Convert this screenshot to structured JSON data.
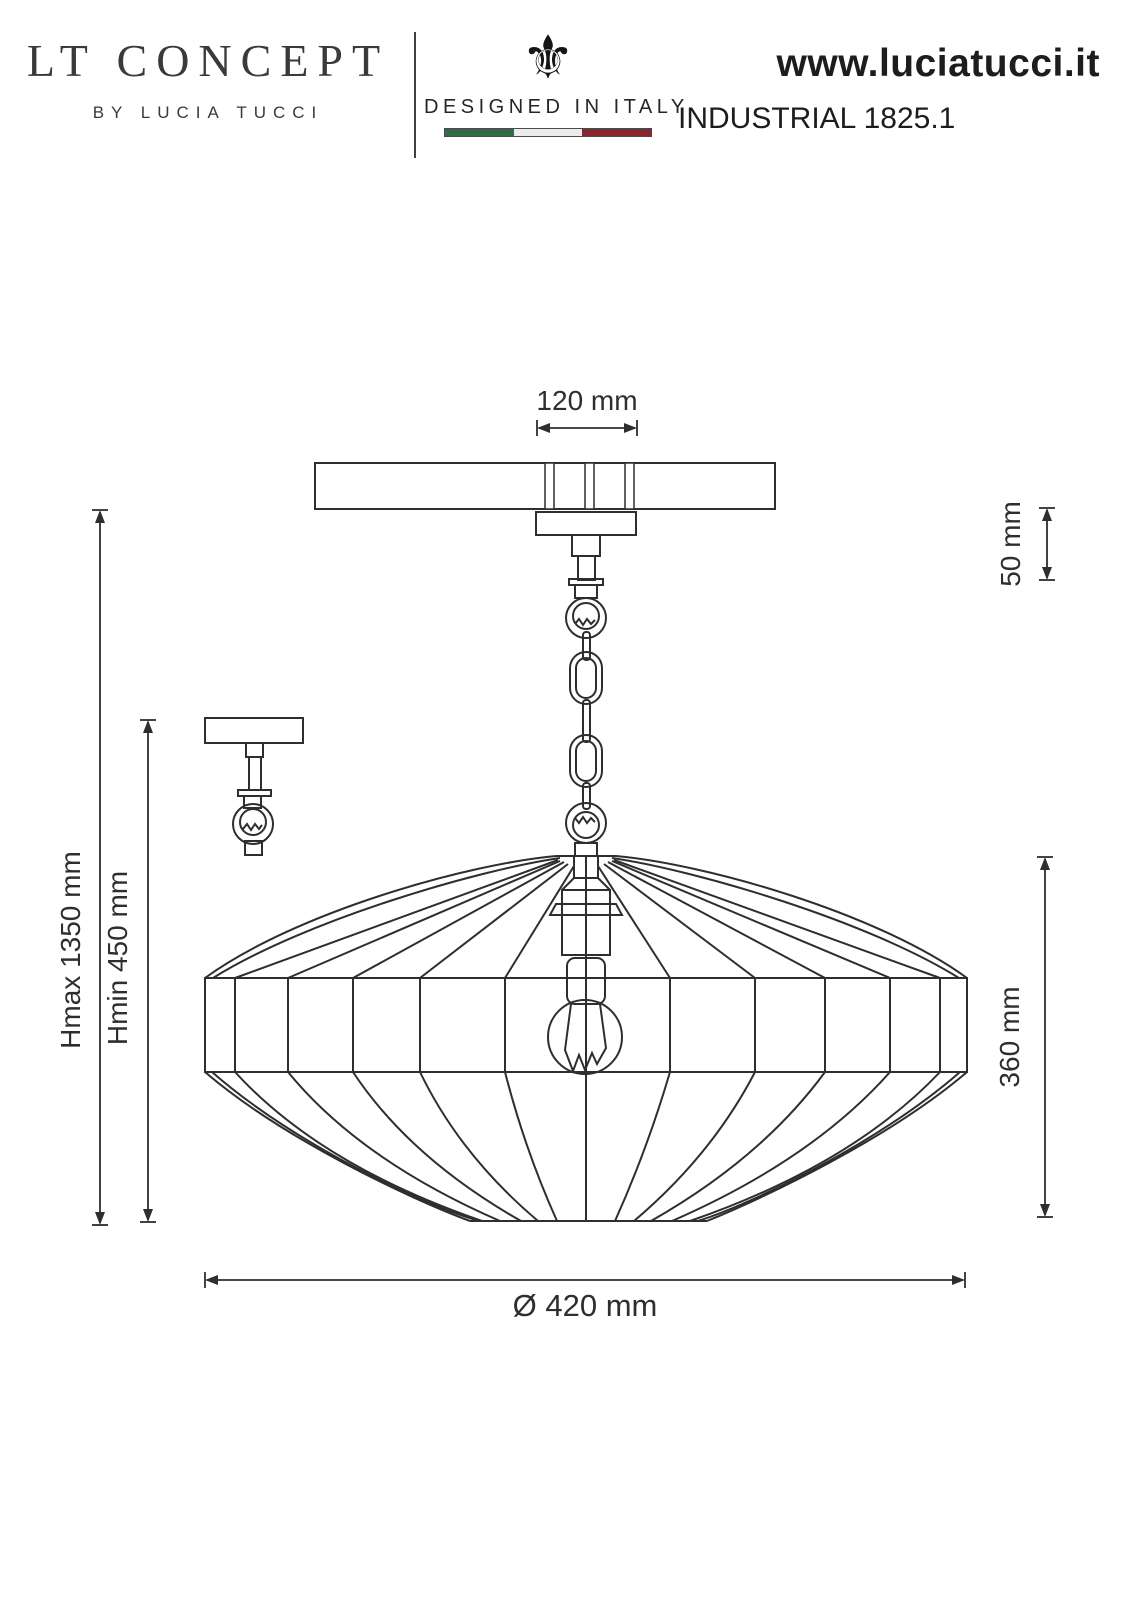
{
  "header": {
    "brand": {
      "title": "LT CONCEPT",
      "subtitle": "BY LUCIA TUCCI"
    },
    "designed_in_italy": {
      "icon": "⚜",
      "label": "DESIGNED IN ITALY",
      "flag_colors": {
        "green": "#2d6e48",
        "white": "#ececec",
        "red": "#8e2330"
      }
    },
    "website": "www.luciatucci.it",
    "model": "INDUSTRIAL 1825.1"
  },
  "drawing": {
    "ink_color": "#2e2e2e",
    "dimensions": {
      "canopy_width": "120 mm",
      "canopy_drop": "50 mm",
      "max_height": "Hmax 1350 mm",
      "min_height": "Hmin 450 mm",
      "shade_height": "360 mm",
      "shade_diameter": "Ø 420 mm"
    }
  }
}
